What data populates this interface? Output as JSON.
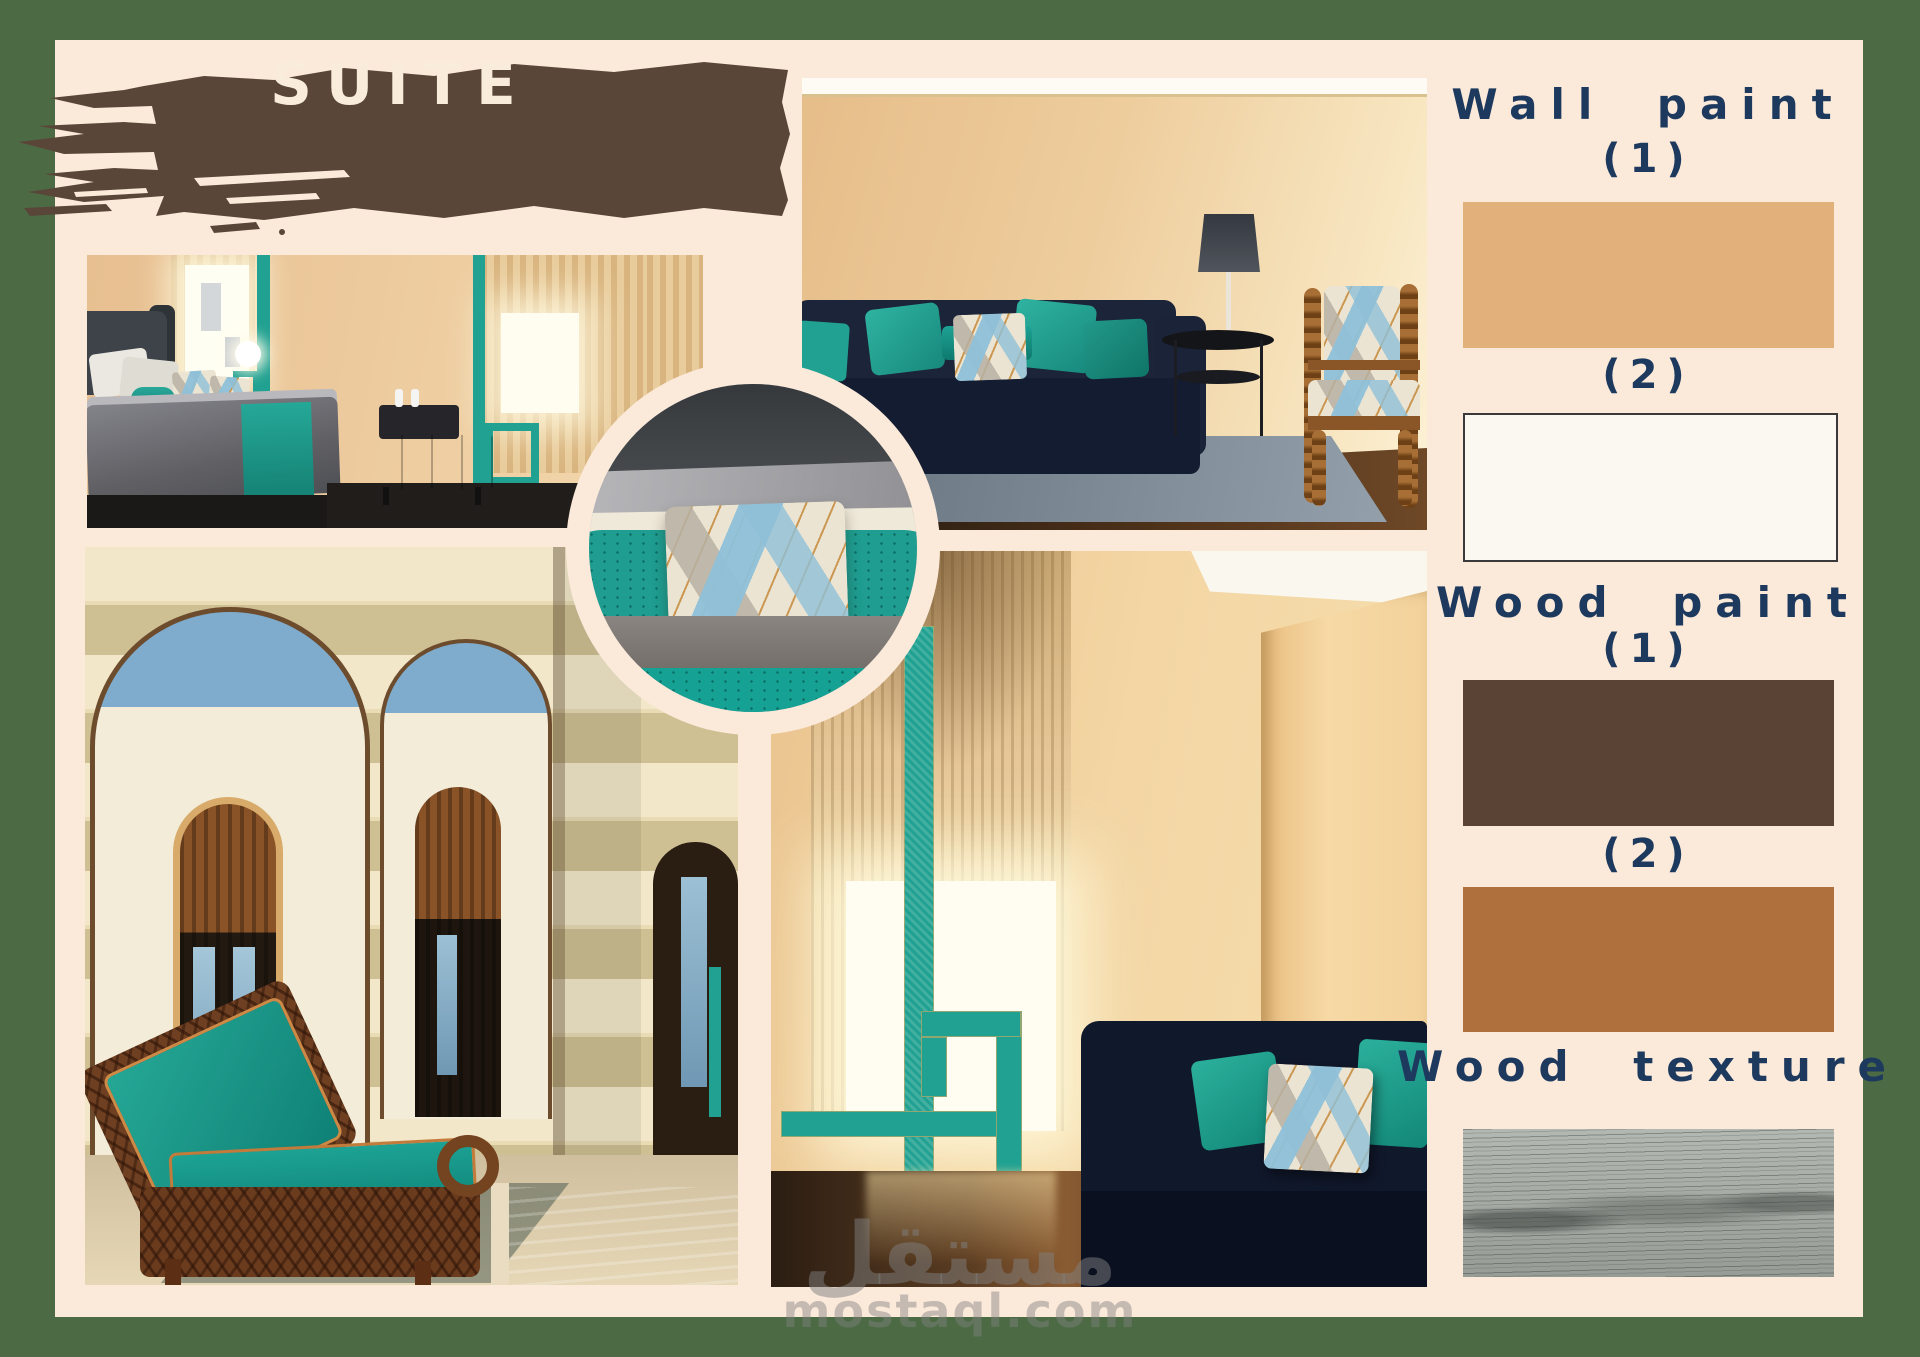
{
  "theme": {
    "css_vars": {
      "--matte": "#4c6b44",
      "--panel": "#fbe9da",
      "--navy": "#1d3a5e",
      "--teal": "#21a191",
      "--brush": "#594638",
      "--brush-text": "#f9ecdb"
    }
  },
  "title": {
    "label": "SUITE"
  },
  "palette": {
    "wall_paint": {
      "heading": "Wall paint",
      "label_1": "(1)",
      "label_2": "(2)",
      "swatch_1": "#e2b07b",
      "swatch_2": "#fbf8f1",
      "swatch_2_border": "#3a3a3a"
    },
    "wood_paint": {
      "heading": "Wood paint",
      "label_1": "(1)",
      "label_2": "(2)",
      "swatch_1": "#5a4234",
      "swatch_2": "#b0703d"
    },
    "wood_texture": {
      "heading": "Wood texture",
      "swatch_base": "#a6aaa5"
    }
  },
  "watermark": {
    "logo_text": "مستقل",
    "site_text": "mostaql.com"
  }
}
